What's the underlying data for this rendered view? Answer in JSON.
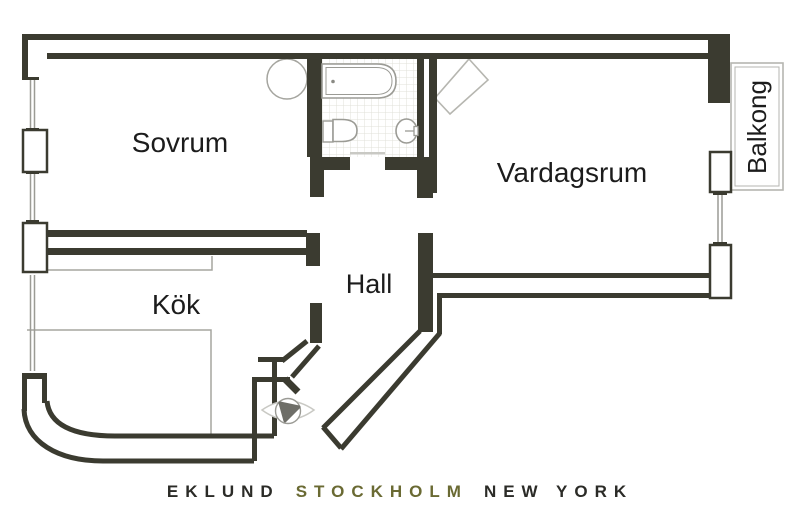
{
  "plan": {
    "title": "Apartment floor plan",
    "rooms": [
      {
        "id": "sovrum",
        "label": "Sovrum"
      },
      {
        "id": "vardagsrum",
        "label": "Vardagsrum"
      },
      {
        "id": "kok",
        "label": "Kök"
      },
      {
        "id": "hall",
        "label": "Hall"
      },
      {
        "id": "balkong",
        "label": "Balkong"
      }
    ],
    "fixtures": [
      "bathtub-icon",
      "toilet-icon",
      "sink-icon",
      "round-stove-icon",
      "corner-fireplace-icon",
      "entrance-door-symbol",
      "kitchen-counter",
      "window",
      "balcony"
    ],
    "colors": {
      "wall": "#3b3b30",
      "fixture_line": "#9b9b95",
      "light_line": "#b6b6b0",
      "tile_line": "#e0e0da",
      "label_text": "#1c1c1c",
      "logo_dark": "#2b2b27",
      "logo_olive": "#6a6a33",
      "background": "#ffffff"
    }
  },
  "footer": {
    "brand": [
      {
        "text": "EKLUND",
        "color": "#2b2b27"
      },
      {
        "text": "STOCKHOLM",
        "color": "#6a6a33"
      },
      {
        "text": "NEW YORK",
        "color": "#2b2b27"
      }
    ]
  }
}
